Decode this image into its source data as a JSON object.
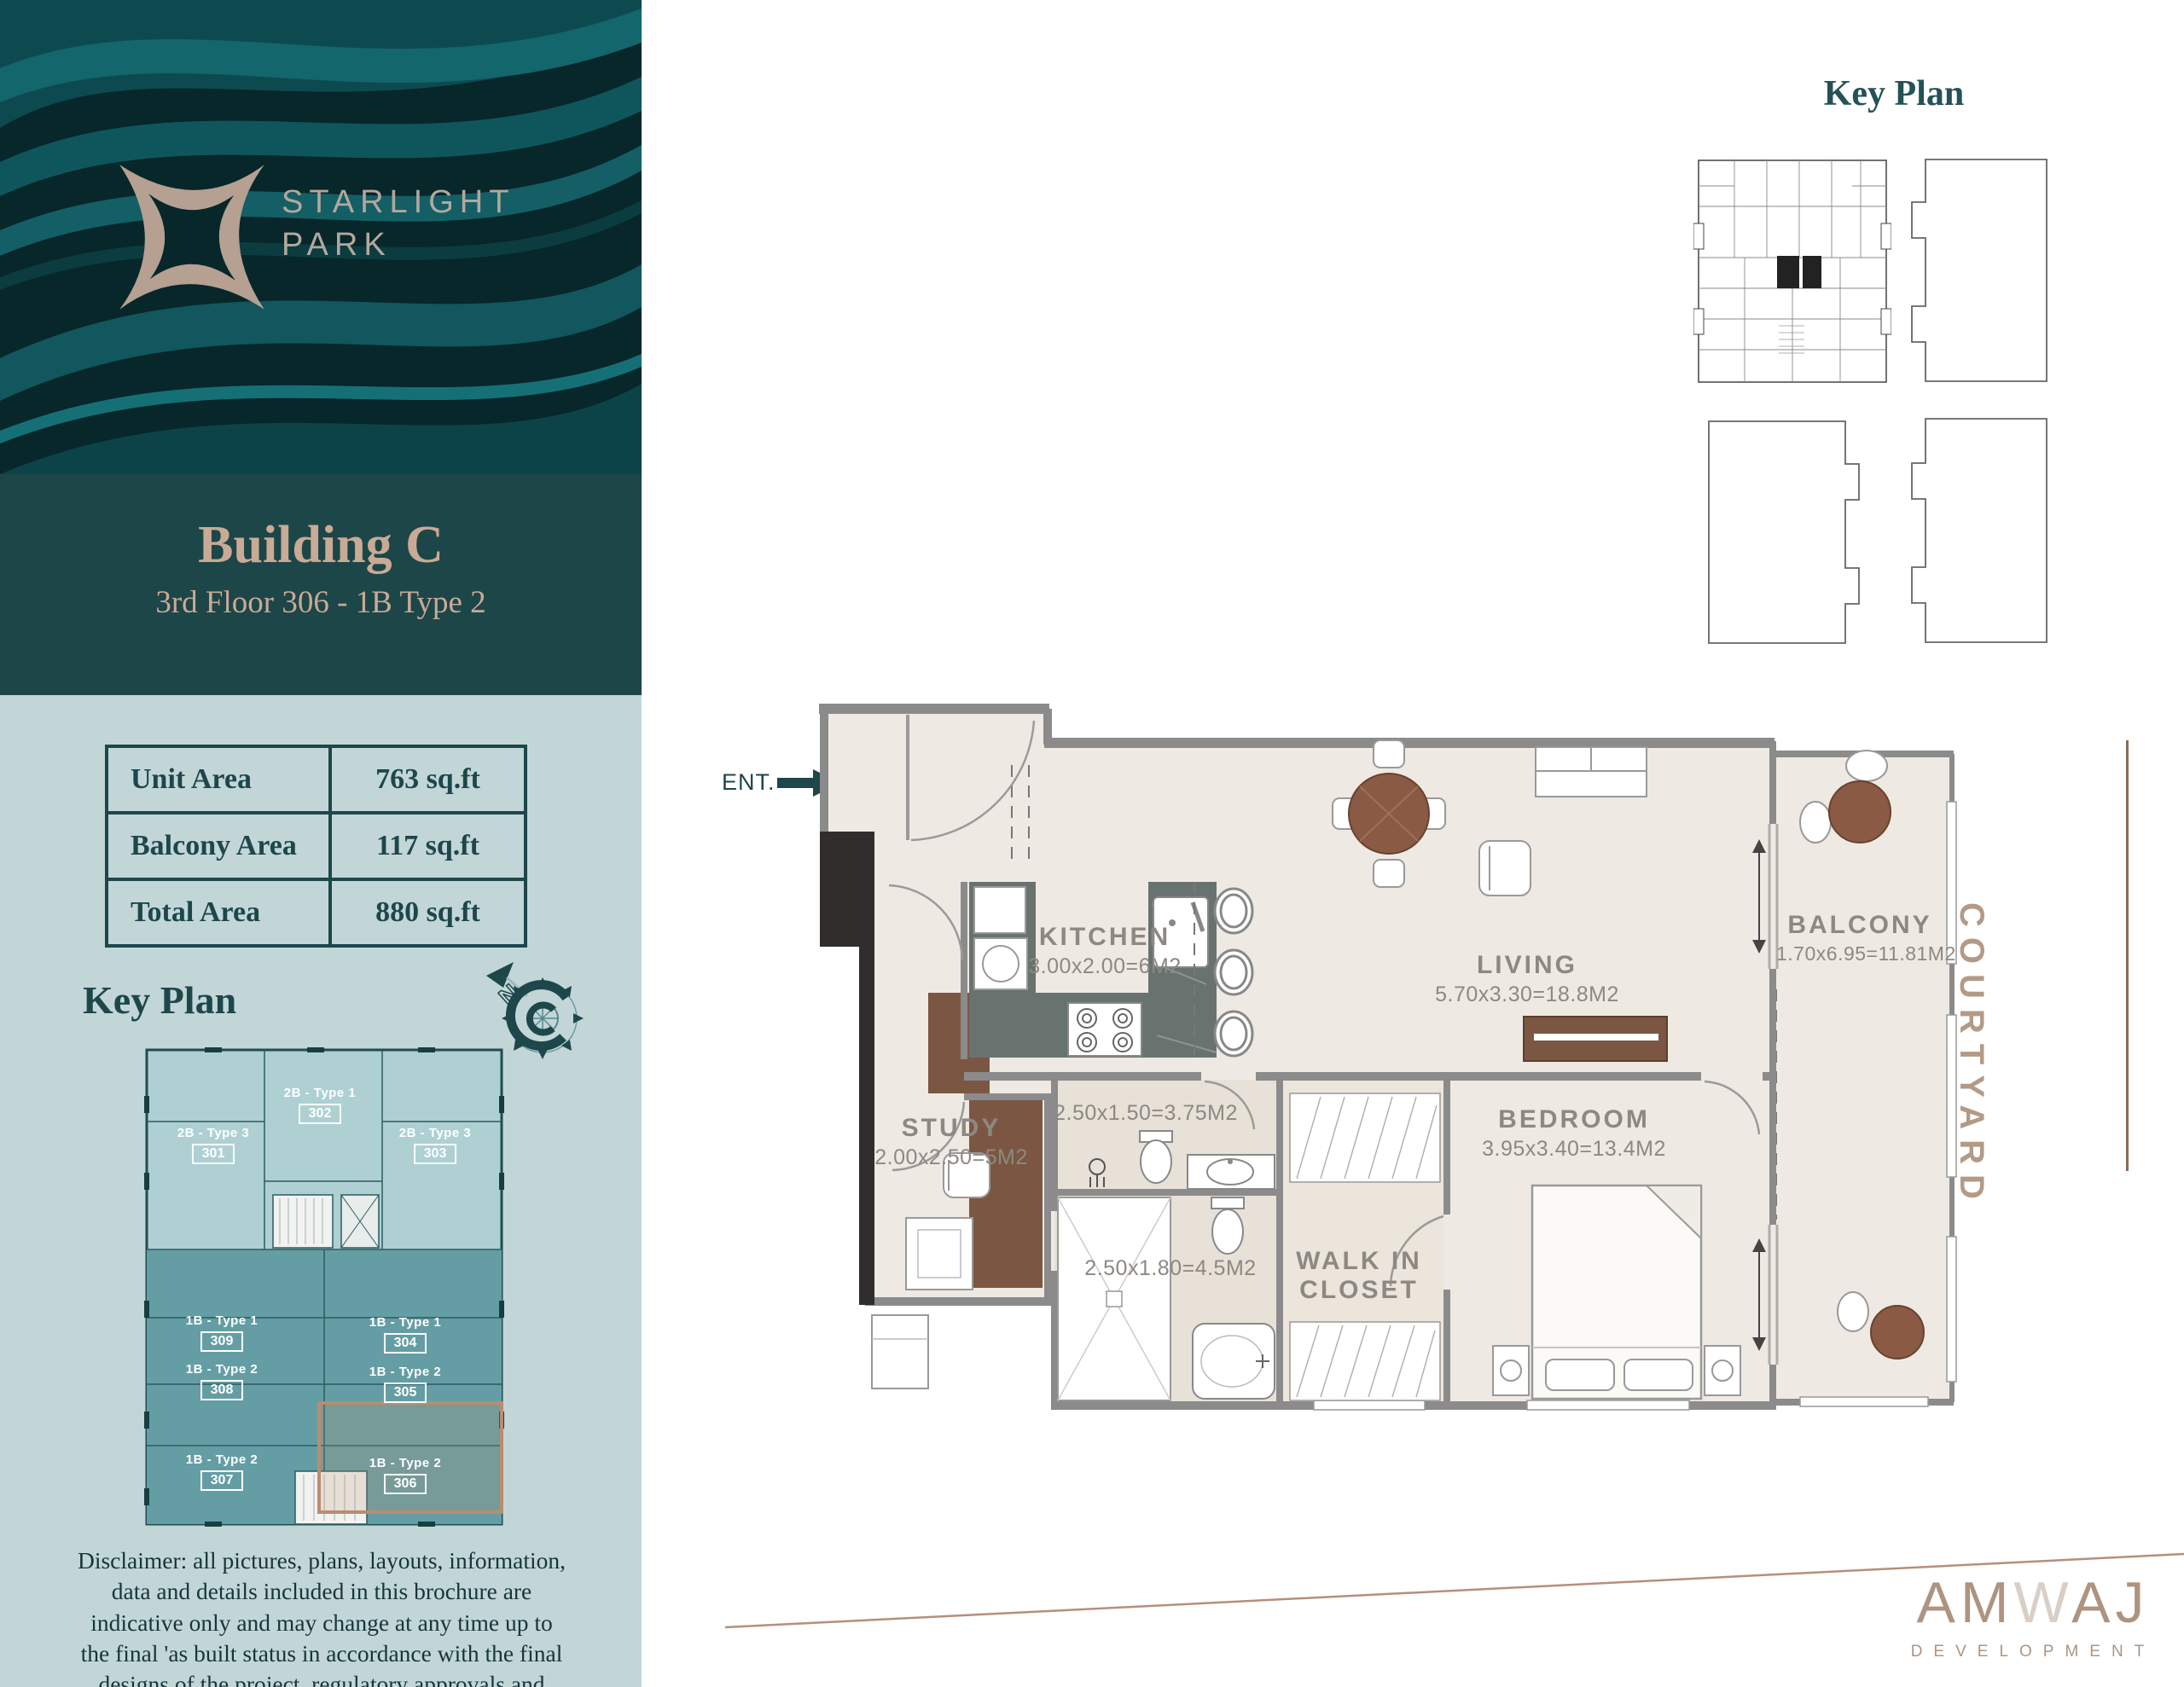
{
  "sidebar": {
    "logo": {
      "line1": "STARLIGHT",
      "line2": "PARK"
    },
    "title": "Building C",
    "subtitle": "3rd Floor 306 - 1B Type 2",
    "area_table": [
      {
        "label": "Unit Area",
        "value": "763 sq.ft"
      },
      {
        "label": "Balcony Area",
        "value": "117 sq.ft"
      },
      {
        "label": "Total Area",
        "value": "880 sq.ft"
      }
    ],
    "keyplan_title": "Key Plan",
    "compass_north_label": "N",
    "keyplan_units": [
      {
        "type": "2B - Type 3",
        "number": "301"
      },
      {
        "type": "2B - Type 1",
        "number": "302"
      },
      {
        "type": "2B - Type 3",
        "number": "303"
      },
      {
        "type": "1B - Type 1",
        "number": "309"
      },
      {
        "type": "1B - Type 1",
        "number": "304"
      },
      {
        "type": "1B - Type 2",
        "number": "308"
      },
      {
        "type": "1B - Type 2",
        "number": "305"
      },
      {
        "type": "1B - Type 2",
        "number": "307"
      },
      {
        "type": "1B - Type 2",
        "number": "306"
      }
    ],
    "disclaimer": "Disclaimer: all pictures, plans, layouts, information, data and details included in this brochure are indicative only and may change at any time up to the final 'as built status in accordance with the final designs of the project, regulatory approvals and planning permissions."
  },
  "main": {
    "keyplan_title": "Key Plan",
    "entrance_label": "ENT.",
    "entrance_unit": "306",
    "courtyard_label": "COURTYARD",
    "rooms": {
      "kitchen": {
        "name": "KITCHEN",
        "dims": "3.00x2.00=6M2"
      },
      "living": {
        "name": "LIVING",
        "dims": "5.70x3.30=18.8M2"
      },
      "balcony": {
        "name": "BALCONY",
        "dims": "1.70x6.95=11.81M2"
      },
      "study": {
        "name": "STUDY",
        "dims": "2.00x2.50=5M2"
      },
      "bedroom": {
        "name": "BEDROOM",
        "dims": "3.95x3.40=13.4M2"
      },
      "walk_in_closet": {
        "line1": "WALK IN",
        "line2": "CLOSET"
      },
      "bath_top": {
        "dims": "2.50x1.50=3.75M2"
      },
      "bath_bottom": {
        "dims": "2.50x1.80=4.5M2"
      }
    },
    "brand": {
      "name_part1": "AM",
      "name_part2": "W",
      "name_part3": "AJ",
      "tagline": "DEVELOPMENT"
    }
  },
  "colors": {
    "dark_teal": "#1d474b",
    "panel_teal": "#1d4649",
    "sidebar_bg": "#c2d6d8",
    "tan_text": "#c9aa95",
    "brand_tan": "#ae9480",
    "highlight": "#b98d6f",
    "keyplan_light_unit": "#aed0d3",
    "keyplan_dark_unit": "#649ea4",
    "floor_fill": "#efe9e3",
    "wall_gray": "#8b8b8b",
    "wood_brown": "#7b5743"
  }
}
